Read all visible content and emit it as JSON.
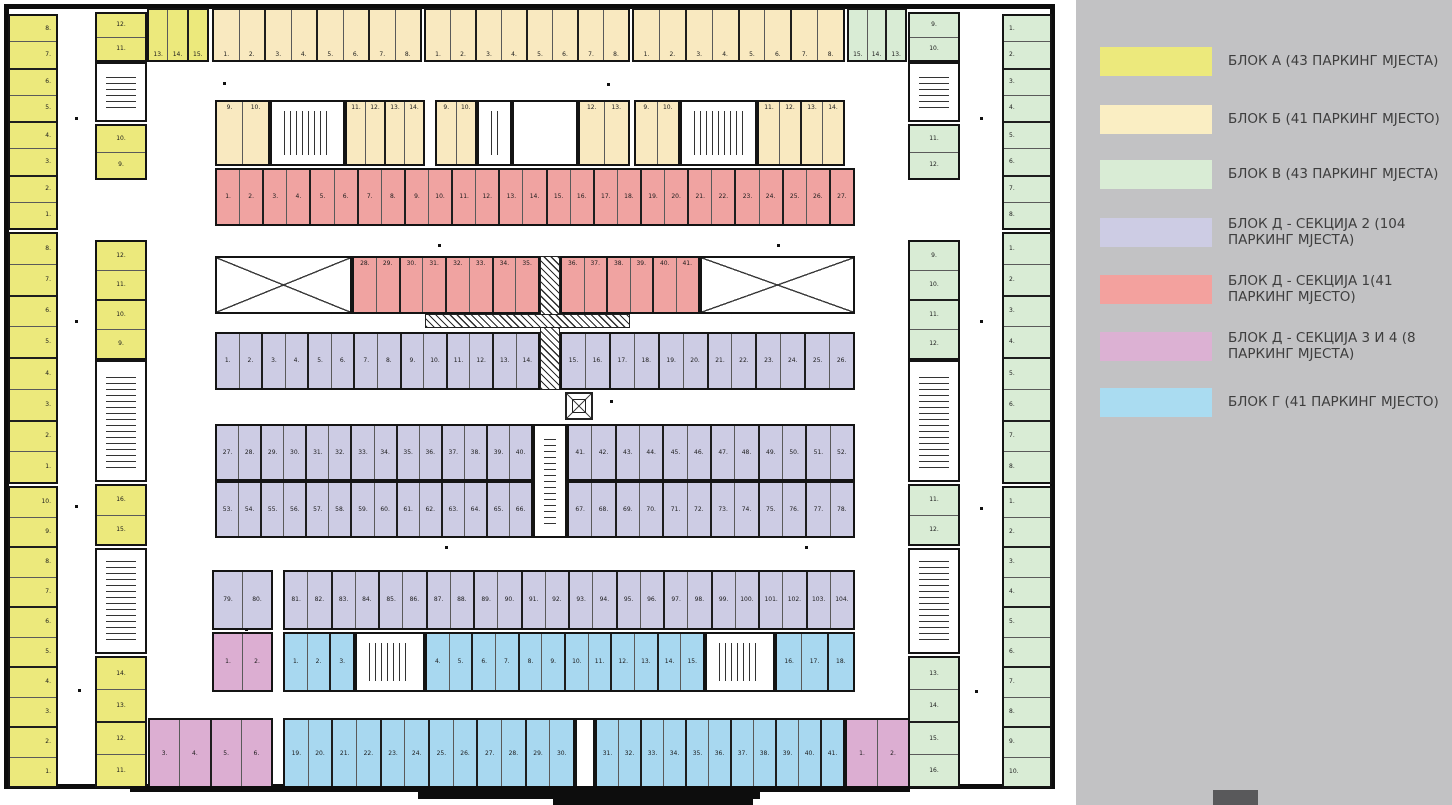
{
  "legend": {
    "panel_color": "#c2c2c4",
    "footer_square_color": "#59595b",
    "items": [
      {
        "y": 47,
        "color": "#ece97c",
        "label": "БЛОК А (43 ПАРКИНГ МЈЕСТА)"
      },
      {
        "y": 105,
        "color": "#faeec3",
        "label": "БЛОК Б (41 ПАРКИНГ МЈЕСТО)"
      },
      {
        "y": 160,
        "color": "#d9ecd5",
        "label": "БЛОК В (43 ПАРКИНГ МЈЕСТА)"
      },
      {
        "y": 218,
        "color": "#cdcce4",
        "label": "БЛОК Д - СЕКЦИЈА 2 (104 ПАРКИНГ МЈЕСТА)"
      },
      {
        "y": 275,
        "color": "#f3a19e",
        "label": "БЛОК Д - СЕКЦИЈА 1(41 ПАРКИНГ МЈЕСТО)"
      },
      {
        "y": 332,
        "color": "#dcb1d3",
        "label": "БЛОК Д - СЕКЦИЈА 3 И 4 (8 ПАРКИНГ МЈЕСТА)"
      },
      {
        "y": 388,
        "color": "#aadcf1",
        "label": " БЛОК Г (41 ПАРКИНГ МЈЕСТО)"
      }
    ]
  },
  "plan": {
    "colors": {
      "A": "#ece97c",
      "B": "#f9e9c0",
      "V": "#d9ecd5",
      "D2": "#cdcce4",
      "D1": "#f0a3a1",
      "D34": "#dcaed2",
      "G": "#a8d8f0"
    },
    "strips": [
      {
        "n": "left-outer-1",
        "b": "A",
        "x": 8,
        "y": 14,
        "w": 50,
        "h": 216,
        "o": "v",
        "lp": "c",
        "la": "r",
        "stalls": [
          "8.",
          "7.",
          "6.",
          "5.",
          "4.",
          "3.",
          "2.",
          "1."
        ]
      },
      {
        "n": "left-outer-2",
        "b": "A",
        "x": 8,
        "y": 232,
        "w": 50,
        "h": 252,
        "o": "v",
        "lp": "c",
        "la": "r",
        "stalls": [
          "8.",
          "7.",
          "6.",
          "5.",
          "4.",
          "3.",
          "2.",
          "1."
        ]
      },
      {
        "n": "left-outer-3",
        "b": "A",
        "x": 8,
        "y": 486,
        "w": 50,
        "h": 302,
        "o": "v",
        "lp": "c",
        "la": "r",
        "stalls": [
          "10.",
          "9.",
          "8.",
          "7.",
          "6.",
          "5.",
          "4.",
          "3.",
          "2.",
          "1."
        ]
      },
      {
        "n": "left-inner-1a",
        "b": "A",
        "x": 95,
        "y": 12,
        "w": 52,
        "h": 50,
        "o": "v",
        "lp": "c",
        "la": "c",
        "stalls": [
          "12.",
          "11."
        ]
      },
      {
        "n": "left-inner-1b",
        "b": "A",
        "x": 95,
        "y": 124,
        "w": 52,
        "h": 56,
        "o": "v",
        "lp": "c",
        "la": "c",
        "stalls": [
          "10.",
          "9."
        ]
      },
      {
        "n": "left-inner-2",
        "b": "A",
        "x": 95,
        "y": 240,
        "w": 52,
        "h": 120,
        "o": "v",
        "lp": "c",
        "la": "c",
        "stalls": [
          "12.",
          "11.",
          "10.",
          "9."
        ]
      },
      {
        "n": "left-inner-3a",
        "b": "A",
        "x": 95,
        "y": 484,
        "w": 52,
        "h": 62,
        "o": "v",
        "lp": "c",
        "la": "c",
        "stalls": [
          "16.",
          "15."
        ]
      },
      {
        "n": "left-inner-3b",
        "b": "A",
        "x": 95,
        "y": 656,
        "w": 52,
        "h": 132,
        "o": "v",
        "lp": "c",
        "la": "c",
        "stalls": [
          "14.",
          "13.",
          "12.",
          "11."
        ]
      },
      {
        "n": "top-yellow",
        "b": "A",
        "x": 147,
        "y": 8,
        "w": 62,
        "h": 54,
        "o": "h",
        "lp": "b",
        "la": "c",
        "stalls": [
          "13.",
          "14.",
          "15."
        ]
      },
      {
        "n": "top-orange-1",
        "b": "B",
        "x": 212,
        "y": 8,
        "w": 210,
        "h": 54,
        "o": "h",
        "lp": "b",
        "la": "c",
        "stalls": [
          "1.",
          "2.",
          "3.",
          "4.",
          "5.",
          "6.",
          "7.",
          "8."
        ]
      },
      {
        "n": "top-orange-2",
        "b": "B",
        "x": 424,
        "y": 8,
        "w": 206,
        "h": 54,
        "o": "h",
        "lp": "b",
        "la": "c",
        "stalls": [
          "1.",
          "2.",
          "3.",
          "4.",
          "5.",
          "6.",
          "7.",
          "8."
        ]
      },
      {
        "n": "top-orange-3",
        "b": "B",
        "x": 632,
        "y": 8,
        "w": 213,
        "h": 54,
        "o": "h",
        "lp": "b",
        "la": "c",
        "stalls": [
          "1.",
          "2.",
          "3.",
          "4.",
          "5.",
          "6.",
          "7.",
          "8."
        ]
      },
      {
        "n": "top-green",
        "b": "V",
        "x": 847,
        "y": 8,
        "w": 60,
        "h": 54,
        "o": "h",
        "lp": "b",
        "la": "c",
        "stalls": [
          "15.",
          "14.",
          "13."
        ]
      },
      {
        "n": "band2-a1",
        "b": "B",
        "x": 215,
        "y": 100,
        "w": 55,
        "h": 66,
        "o": "h",
        "lp": "t",
        "la": "c",
        "stalls": [
          "9.",
          "10."
        ]
      },
      {
        "n": "band2-a2",
        "b": "B",
        "x": 345,
        "y": 100,
        "w": 80,
        "h": 66,
        "o": "h",
        "lp": "t",
        "la": "c",
        "stalls": [
          "11.",
          "12.",
          "13.",
          "14."
        ]
      },
      {
        "n": "band2-b1",
        "b": "B",
        "x": 435,
        "y": 100,
        "w": 42,
        "h": 66,
        "o": "h",
        "lp": "t",
        "la": "c",
        "stalls": [
          "9.",
          "10."
        ]
      },
      {
        "n": "band2-b2",
        "b": "B",
        "x": 578,
        "y": 100,
        "w": 52,
        "h": 66,
        "o": "h",
        "lp": "t",
        "la": "c",
        "stalls": [
          "12.",
          "13."
        ]
      },
      {
        "n": "band2-c1",
        "b": "B",
        "x": 634,
        "y": 100,
        "w": 46,
        "h": 66,
        "o": "h",
        "lp": "t",
        "la": "c",
        "stalls": [
          "9.",
          "10."
        ]
      },
      {
        "n": "band2-c2",
        "b": "B",
        "x": 757,
        "y": 100,
        "w": 88,
        "h": 66,
        "o": "h",
        "lp": "t",
        "la": "c",
        "stalls": [
          "11.",
          "12.",
          "13.",
          "14."
        ]
      },
      {
        "n": "red-row1",
        "b": "D1",
        "x": 215,
        "y": 168,
        "w": 640,
        "h": 58,
        "o": "h",
        "lp": "c",
        "la": "c",
        "stalls": [
          "1.",
          "2.",
          "3.",
          "4.",
          "5.",
          "6.",
          "7.",
          "8.",
          "9.",
          "10.",
          "11.",
          "12.",
          "13.",
          "14.",
          "15.",
          "16.",
          "17.",
          "18.",
          "19.",
          "20.",
          "21.",
          "22.",
          "23.",
          "24.",
          "25.",
          "26.",
          "27."
        ]
      },
      {
        "n": "red-row2-left",
        "b": "D1",
        "x": 352,
        "y": 256,
        "w": 188,
        "h": 58,
        "o": "h",
        "lp": "t",
        "la": "c",
        "stalls": [
          "28.",
          "29.",
          "30.",
          "31.",
          "32.",
          "33.",
          "34.",
          "35."
        ]
      },
      {
        "n": "red-row2-right",
        "b": "D1",
        "x": 560,
        "y": 256,
        "w": 140,
        "h": 58,
        "o": "h",
        "lp": "t",
        "la": "c",
        "stalls": [
          "36.",
          "37.",
          "38.",
          "39.",
          "40.",
          "41."
        ]
      },
      {
        "n": "lav-row1-left",
        "b": "D2",
        "x": 215,
        "y": 332,
        "w": 325,
        "h": 58,
        "o": "h",
        "lp": "c",
        "la": "c",
        "stalls": [
          "1.",
          "2.",
          "3.",
          "4.",
          "5.",
          "6.",
          "7.",
          "8.",
          "9.",
          "10.",
          "11.",
          "12.",
          "13.",
          "14."
        ]
      },
      {
        "n": "lav-row1-right",
        "b": "D2",
        "x": 560,
        "y": 332,
        "w": 295,
        "h": 58,
        "o": "h",
        "lp": "c",
        "la": "c",
        "stalls": [
          "15.",
          "16.",
          "17.",
          "18.",
          "19.",
          "20.",
          "21.",
          "22.",
          "23.",
          "24.",
          "25.",
          "26."
        ]
      },
      {
        "n": "lav-row2-left",
        "b": "D2",
        "x": 215,
        "y": 424,
        "w": 318,
        "h": 57,
        "o": "h",
        "lp": "c",
        "la": "c",
        "stalls": [
          "27.",
          "28.",
          "29.",
          "30.",
          "31.",
          "32.",
          "33.",
          "34.",
          "35.",
          "36.",
          "37.",
          "38.",
          "39.",
          "40."
        ]
      },
      {
        "n": "lav-row2-right",
        "b": "D2",
        "x": 567,
        "y": 424,
        "w": 288,
        "h": 57,
        "o": "h",
        "lp": "c",
        "la": "c",
        "stalls": [
          "41.",
          "42.",
          "43.",
          "44.",
          "45.",
          "46.",
          "47.",
          "48.",
          "49.",
          "50.",
          "51.",
          "52."
        ]
      },
      {
        "n": "lav-row3-left",
        "b": "D2",
        "x": 215,
        "y": 481,
        "w": 318,
        "h": 57,
        "o": "h",
        "lp": "c",
        "la": "c",
        "stalls": [
          "53.",
          "54.",
          "55.",
          "56.",
          "57.",
          "58.",
          "59.",
          "60.",
          "61.",
          "62.",
          "63.",
          "64.",
          "65.",
          "66."
        ]
      },
      {
        "n": "lav-row3-right",
        "b": "D2",
        "x": 567,
        "y": 481,
        "w": 288,
        "h": 57,
        "o": "h",
        "lp": "c",
        "la": "c",
        "stalls": [
          "67.",
          "68.",
          "69.",
          "70.",
          "71.",
          "72.",
          "73.",
          "74.",
          "75.",
          "76.",
          "77.",
          "78."
        ]
      },
      {
        "n": "lav-row4-a",
        "b": "D2",
        "x": 212,
        "y": 570,
        "w": 61,
        "h": 60,
        "o": "h",
        "lp": "c",
        "la": "c",
        "stalls": [
          "79.",
          "80."
        ]
      },
      {
        "n": "lav-row4-b",
        "b": "D2",
        "x": 283,
        "y": 570,
        "w": 572,
        "h": 60,
        "o": "h",
        "lp": "c",
        "la": "c",
        "stalls": [
          "81.",
          "82.",
          "83.",
          "84.",
          "85.",
          "86.",
          "87.",
          "88.",
          "89.",
          "90.",
          "91.",
          "92.",
          "93.",
          "94.",
          "95.",
          "96.",
          "97.",
          "98.",
          "99.",
          "100.",
          "101.",
          "102.",
          "103.",
          "104."
        ]
      },
      {
        "n": "pink-a",
        "b": "D34",
        "x": 212,
        "y": 632,
        "w": 61,
        "h": 60,
        "o": "h",
        "lp": "c",
        "la": "c",
        "stalls": [
          "1.",
          "2."
        ]
      },
      {
        "n": "blue-row1-a",
        "b": "G",
        "x": 283,
        "y": 632,
        "w": 72,
        "h": 60,
        "o": "h",
        "lp": "c",
        "la": "c",
        "stalls": [
          "1.",
          "2.",
          "3."
        ]
      },
      {
        "n": "blue-row1-b",
        "b": "G",
        "x": 425,
        "y": 632,
        "w": 280,
        "h": 60,
        "o": "h",
        "lp": "c",
        "la": "c",
        "stalls": [
          "4.",
          "5.",
          "6.",
          "7.",
          "8.",
          "9.",
          "10.",
          "11.",
          "12.",
          "13.",
          "14.",
          "15."
        ]
      },
      {
        "n": "blue-row1-c",
        "b": "G",
        "x": 775,
        "y": 632,
        "w": 80,
        "h": 60,
        "o": "h",
        "lp": "c",
        "la": "c",
        "stalls": [
          "16.",
          "17.",
          "18."
        ]
      },
      {
        "n": "pink-b",
        "b": "D34",
        "x": 148,
        "y": 718,
        "w": 125,
        "h": 72,
        "o": "h",
        "lp": "c",
        "la": "c",
        "stalls": [
          "3.",
          "4.",
          "5.",
          "6."
        ]
      },
      {
        "n": "blue-row2-a",
        "b": "G",
        "x": 283,
        "y": 718,
        "w": 292,
        "h": 72,
        "o": "h",
        "lp": "c",
        "la": "c",
        "stalls": [
          "19.",
          "20.",
          "21.",
          "22.",
          "23.",
          "24.",
          "25.",
          "26.",
          "27.",
          "28.",
          "29.",
          "30."
        ]
      },
      {
        "n": "blue-row2-b",
        "b": "G",
        "x": 595,
        "y": 718,
        "w": 250,
        "h": 72,
        "o": "h",
        "lp": "c",
        "la": "c",
        "stalls": [
          "31.",
          "32.",
          "33.",
          "34.",
          "35.",
          "36.",
          "37.",
          "38.",
          "39.",
          "40.",
          "41."
        ]
      },
      {
        "n": "pink-c",
        "b": "D34",
        "x": 845,
        "y": 718,
        "w": 65,
        "h": 72,
        "o": "h",
        "lp": "c",
        "la": "c",
        "stalls": [
          "1.",
          "2."
        ]
      },
      {
        "n": "right-inner-1a",
        "b": "V",
        "x": 908,
        "y": 12,
        "w": 52,
        "h": 50,
        "o": "v",
        "lp": "c",
        "la": "c",
        "stalls": [
          "9.",
          "10."
        ]
      },
      {
        "n": "right-inner-1b",
        "b": "V",
        "x": 908,
        "y": 124,
        "w": 52,
        "h": 56,
        "o": "v",
        "lp": "c",
        "la": "c",
        "stalls": [
          "11.",
          "12."
        ]
      },
      {
        "n": "right-inner-2",
        "b": "V",
        "x": 908,
        "y": 240,
        "w": 52,
        "h": 120,
        "o": "v",
        "lp": "c",
        "la": "c",
        "stalls": [
          "9.",
          "10.",
          "11.",
          "12."
        ]
      },
      {
        "n": "right-inner-3a",
        "b": "V",
        "x": 908,
        "y": 484,
        "w": 52,
        "h": 62,
        "o": "v",
        "lp": "c",
        "la": "c",
        "stalls": [
          "11.",
          "12."
        ]
      },
      {
        "n": "right-inner-3b",
        "b": "V",
        "x": 908,
        "y": 656,
        "w": 52,
        "h": 132,
        "o": "v",
        "lp": "c",
        "la": "c",
        "stalls": [
          "13.",
          "14.",
          "15.",
          "16."
        ]
      },
      {
        "n": "right-outer-1",
        "b": "V",
        "x": 1002,
        "y": 14,
        "w": 50,
        "h": 216,
        "o": "v",
        "lp": "c",
        "la": "l",
        "stalls": [
          "1.",
          "2.",
          "3.",
          "4.",
          "5.",
          "6.",
          "7.",
          "8."
        ]
      },
      {
        "n": "right-outer-2",
        "b": "V",
        "x": 1002,
        "y": 232,
        "w": 50,
        "h": 252,
        "o": "v",
        "lp": "c",
        "la": "l",
        "stalls": [
          "1.",
          "2.",
          "3.",
          "4.",
          "5.",
          "6.",
          "7.",
          "8."
        ]
      },
      {
        "n": "right-outer-3",
        "b": "V",
        "x": 1002,
        "y": 486,
        "w": 50,
        "h": 302,
        "o": "v",
        "lp": "c",
        "la": "l",
        "stalls": [
          "1.",
          "2.",
          "3.",
          "4.",
          "5.",
          "6.",
          "7.",
          "8.",
          "9.",
          "10."
        ]
      }
    ],
    "stairs": [
      {
        "x": 95,
        "y": 62,
        "w": 52,
        "h": 60,
        "d": "v"
      },
      {
        "x": 95,
        "y": 360,
        "w": 52,
        "h": 122,
        "d": "v"
      },
      {
        "x": 95,
        "y": 548,
        "w": 52,
        "h": 106,
        "d": "v"
      },
      {
        "x": 908,
        "y": 62,
        "w": 52,
        "h": 60,
        "d": "v"
      },
      {
        "x": 908,
        "y": 360,
        "w": 52,
        "h": 122,
        "d": "v"
      },
      {
        "x": 908,
        "y": 548,
        "w": 52,
        "h": 106,
        "d": "v"
      },
      {
        "x": 270,
        "y": 100,
        "w": 75,
        "h": 66,
        "d": "h"
      },
      {
        "x": 477,
        "y": 100,
        "w": 35,
        "h": 66,
        "d": "h"
      },
      {
        "x": 680,
        "y": 100,
        "w": 77,
        "h": 66,
        "d": "h"
      },
      {
        "x": 355,
        "y": 632,
        "w": 70,
        "h": 60,
        "d": "h"
      },
      {
        "x": 705,
        "y": 632,
        "w": 70,
        "h": 60,
        "d": "h"
      },
      {
        "x": 533,
        "y": 424,
        "w": 34,
        "h": 114,
        "d": "v"
      }
    ],
    "rooms": [
      {
        "x": 512,
        "y": 100,
        "w": 66,
        "h": 66
      },
      {
        "x": 575,
        "y": 718,
        "w": 20,
        "h": 72
      }
    ],
    "hatches": [
      {
        "x": 540,
        "y": 256,
        "w": 20,
        "h": 134
      },
      {
        "x": 425,
        "y": 314,
        "w": 205,
        "h": 14
      }
    ],
    "xbraces": [
      {
        "x": 215,
        "y": 256,
        "w": 137,
        "h": 58
      },
      {
        "x": 700,
        "y": 256,
        "w": 155,
        "h": 58
      }
    ],
    "elevator": {
      "x": 565,
      "y": 392,
      "w": 28,
      "h": 28
    },
    "steps": [
      {
        "x": 130,
        "y": 786,
        "w": 780,
        "h": 6
      },
      {
        "x": 418,
        "y": 792,
        "w": 342,
        "h": 7
      },
      {
        "x": 553,
        "y": 799,
        "w": 200,
        "h": 6
      }
    ],
    "dots": [
      [
        75,
        117
      ],
      [
        75,
        320
      ],
      [
        75,
        505
      ],
      [
        78,
        689
      ],
      [
        223,
        82
      ],
      [
        607,
        83
      ],
      [
        438,
        244
      ],
      [
        777,
        244
      ],
      [
        610,
        400
      ],
      [
        445,
        546
      ],
      [
        805,
        546
      ],
      [
        245,
        628
      ],
      [
        980,
        117
      ],
      [
        980,
        320
      ],
      [
        980,
        507
      ],
      [
        975,
        690
      ]
    ]
  }
}
